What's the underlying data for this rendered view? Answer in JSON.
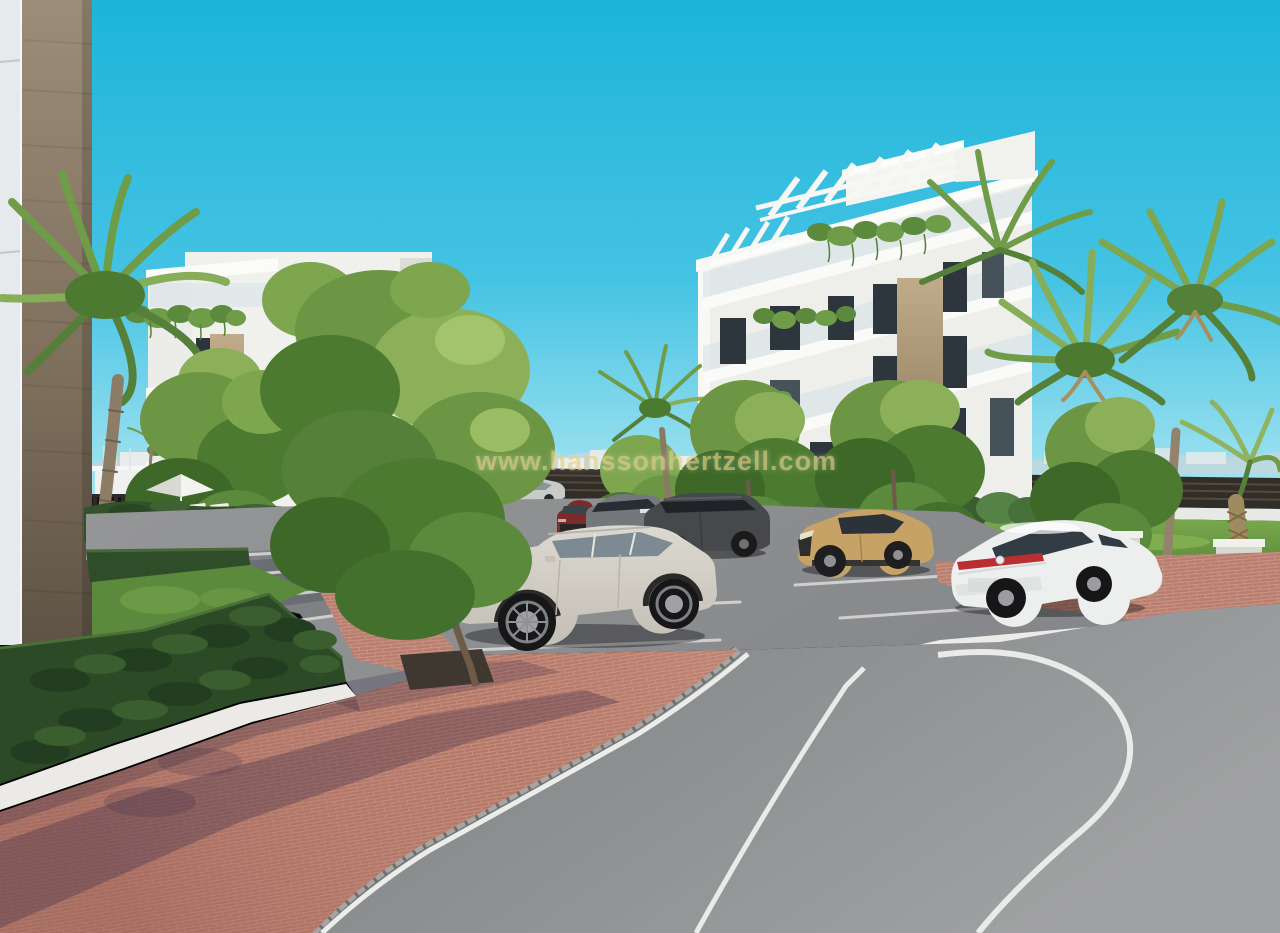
{
  "scene": {
    "type": "architectural-3d-render",
    "title": "Residential complex exterior visualisation",
    "watermark": "www.hanssonhertzell.com",
    "setting": "Two modern white apartment buildings with rooftop pergolas and planted balconies, palm trees, clipped hedges, a paver parking area with cars and a curved asphalt road under a clear cyan sky"
  },
  "palette": {
    "sky_top": "#1db4da",
    "sky_horizon": "#aee7f2",
    "building_white": "#efefec",
    "stone_tan": "#b29a79",
    "foliage_green": "#6c9544",
    "hedge_green": "#2c4a26",
    "palm_green": "#789f4c",
    "lawn_green": "#5c8a3c",
    "paver_red": "#b27468",
    "asphalt_grey": "#8a8c8e",
    "gravel_white": "#eceae6",
    "concrete_column": "#7c6e5b",
    "watermark_gold": "rgba(228,205,128,0.62)"
  },
  "vehicles": [
    {
      "name": "teal-hatchback",
      "color": "#3f5a5e"
    },
    {
      "name": "dark-grey-sedan",
      "color": "#3c3f42"
    },
    {
      "name": "distant-silver-estate",
      "color": "#c9cbc9"
    },
    {
      "name": "dark-red-suv",
      "color": "#7c2b2c"
    },
    {
      "name": "grey-suv-chrome-grille",
      "color": "#74777b"
    },
    {
      "name": "graphite-suv",
      "color": "#46484b"
    },
    {
      "name": "silver-crossover-suv",
      "color": "#d0ccc4"
    },
    {
      "name": "tan-compact-suv",
      "color": "#c7a266"
    },
    {
      "name": "white-fastback-sedan",
      "color": "#edefee"
    }
  ],
  "buildings": [
    {
      "name": "foreground-concrete-corner",
      "material": "tan concrete and white panel"
    },
    {
      "name": "left-apartment-block",
      "floors": 4,
      "features": "white balconies, hanging plants, stone-clad column"
    },
    {
      "name": "right-apartment-block",
      "floors": 4,
      "features": "rooftop pergola slats, glass balustrades, hanging plants, stone-clad slab"
    }
  ],
  "landscape": [
    {
      "name": "hedged-garden-with-parasol-and-loungers"
    },
    {
      "name": "clipped-hedge-rows"
    },
    {
      "name": "palm-trees"
    },
    {
      "name": "deciduous-trees"
    },
    {
      "name": "red-paver-plaza-and-walkways"
    },
    {
      "name": "white-gravel-strips"
    },
    {
      "name": "parking-stalls-with-white-lines"
    },
    {
      "name": "curved-asphalt-road-with-white-lane-lines"
    },
    {
      "name": "white-concrete-benches-on-lawn"
    },
    {
      "name": "distant-coastal-town-and-mountains"
    }
  ]
}
